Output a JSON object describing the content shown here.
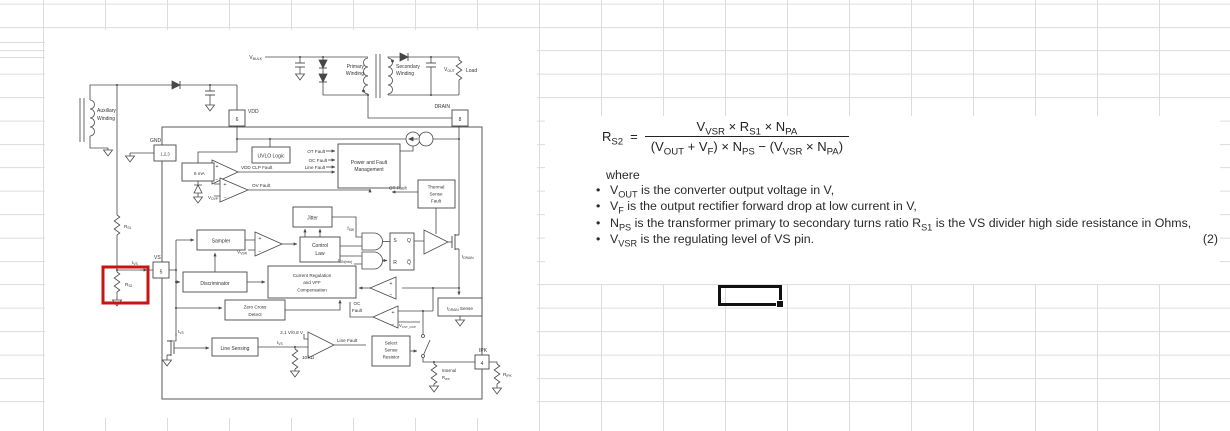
{
  "app": {
    "type": "spreadsheet-with-embedded-figure"
  },
  "colors": {
    "gridline": "#dcdcdc",
    "diagram_ink": "#474747",
    "highlight_red": "#c81414",
    "selection_black": "#111111"
  },
  "text_panel": {
    "equation": {
      "lhs": [
        {
          "t": "R"
        },
        {
          "t": "S2",
          "sub": true
        }
      ],
      "equals": "=",
      "numerator": [
        {
          "t": "V"
        },
        {
          "t": "VSR",
          "sub": true
        },
        {
          "t": " × R"
        },
        {
          "t": "S1",
          "sub": true
        },
        {
          "t": " × N"
        },
        {
          "t": "PA",
          "sub": true
        }
      ],
      "denominator": [
        {
          "t": "(V"
        },
        {
          "t": "OUT",
          "sub": true
        },
        {
          "t": " + V"
        },
        {
          "t": "F",
          "sub": true
        },
        {
          "t": ") × N"
        },
        {
          "t": "PS",
          "sub": true
        },
        {
          "t": " − (V"
        },
        {
          "t": "VSR",
          "sub": true
        },
        {
          "t": " × N"
        },
        {
          "t": "PA",
          "sub": true
        },
        {
          "t": ")"
        }
      ],
      "number": "(2)"
    },
    "where_label": "where",
    "bullet_char": "•",
    "bullets": [
      {
        "tokens": [
          {
            "t": "V"
          },
          {
            "t": "OUT",
            "sub": true
          },
          {
            "t": " is the converter output voltage in V,"
          }
        ]
      },
      {
        "tokens": [
          {
            "t": "V"
          },
          {
            "t": "F",
            "sub": true
          },
          {
            "t": " is the output rectifier forward drop at low current in V,"
          }
        ]
      },
      {
        "tokens": [
          {
            "t": "N"
          },
          {
            "t": "PS",
            "sub": true
          },
          {
            "t": " is the transformer primary to secondary turns ratio R"
          },
          {
            "t": "S1",
            "sub": true
          },
          {
            "t": " is the VS divider high side resistance in Ohms,"
          }
        ]
      },
      {
        "tokens": [
          {
            "t": "V"
          },
          {
            "t": "VSR",
            "sub": true
          },
          {
            "t": " is the regulating level of VS pin."
          }
        ]
      }
    ]
  },
  "selected_cell": {
    "value": ""
  },
  "diagram": {
    "labels": {
      "vbulk": [
        {
          "t": "V"
        },
        {
          "t": "BULK",
          "sub": true
        }
      ],
      "primary1": "Primary",
      "primary2": "Winding",
      "secondary1": "Secondary",
      "secondary2": "Winding",
      "vout": [
        {
          "t": "V"
        },
        {
          "t": "OUT",
          "sub": true
        }
      ],
      "load": "Load",
      "aux1": "Auxiliary",
      "aux2": "Winding",
      "vdd": "VDD",
      "pin6": "6",
      "drain": "DRAIN",
      "pin8": "8",
      "gnd": "GND",
      "pin123": "1,2,3",
      "vs": "VS",
      "pin5": "5",
      "ipk": "IPK",
      "pin4": "4",
      "uvlo": "UVLO Logic",
      "ot_fault": "OT Fault",
      "oc_fault": "OC Fault",
      "line_fault": "Line Fault",
      "pfm1": "Power and Fault",
      "pfm2": "Management",
      "ma6": "6 mA",
      "vddclp": "VDD CLP Fault",
      "vovp": [
        {
          "t": "V"
        },
        {
          "t": "OVP",
          "sub": true
        }
      ],
      "ovfault": "OV Fault",
      "thermal1": "Thermal",
      "thermal2": "Sense",
      "thermal3": "Fault",
      "ot_fault2": "OT Fault",
      "jitter": "Jitter",
      "fsw": [
        {
          "t": "f"
        },
        {
          "t": "SW",
          "sub": true
        }
      ],
      "sampler": "Sampler",
      "vvsr": [
        {
          "t": "V"
        },
        {
          "t": "VSR",
          "sub": true
        }
      ],
      "control1": "Control",
      "control2": "Law",
      "discriminator": "Discriminator",
      "creg1": "Current Regulation",
      "creg2": "and VFF",
      "creg3": "Compensation",
      "zcd1": "Zero Cross",
      "zcd2": "Detect",
      "s": "S",
      "q": "Q",
      "r": "R",
      "qbar": "Q̅",
      "ton": [
        {
          "t": "t"
        },
        {
          "t": "ON(min)",
          "sub": true
        }
      ],
      "idrain": [
        {
          "t": "I"
        },
        {
          "t": "DRAIN",
          "sub": true
        }
      ],
      "idrainsense": [
        {
          "t": "I"
        },
        {
          "t": "DRAIN",
          "sub": true
        },
        {
          "t": " Sense"
        }
      ],
      "oc1": "OC",
      "oc2": "Fault",
      "vcstocp": [
        {
          "t": "V"
        },
        {
          "t": "CST_OCP",
          "sub": true
        }
      ],
      "select1": "Select",
      "select2": "Sense",
      "select3": "Resistor",
      "internal1": "Internal",
      "internal2": [
        {
          "t": "R"
        },
        {
          "t": "IPK",
          "sub": true
        }
      ],
      "ripk": [
        {
          "t": "R"
        },
        {
          "t": "IPK",
          "sub": true
        }
      ],
      "ivs_a": [
        {
          "t": "I"
        },
        {
          "t": "VS",
          "sub": true
        }
      ],
      "ivs_b": [
        {
          "t": "I"
        },
        {
          "t": "VS",
          "sub": true
        }
      ],
      "ivs_c": [
        {
          "t": "I"
        },
        {
          "t": "VS",
          "sub": true
        }
      ],
      "linesensing": "Line Sensing",
      "vhys": "2.1 V/0.8 V",
      "k10": "10 kΩ",
      "linefault2": "Line Fault",
      "rs1": [
        {
          "t": "R"
        },
        {
          "t": "S1",
          "sub": true
        }
      ],
      "rs2": [
        {
          "t": "R"
        },
        {
          "t": "S2",
          "sub": true
        }
      ],
      "plus": "+",
      "minus": "−"
    }
  }
}
